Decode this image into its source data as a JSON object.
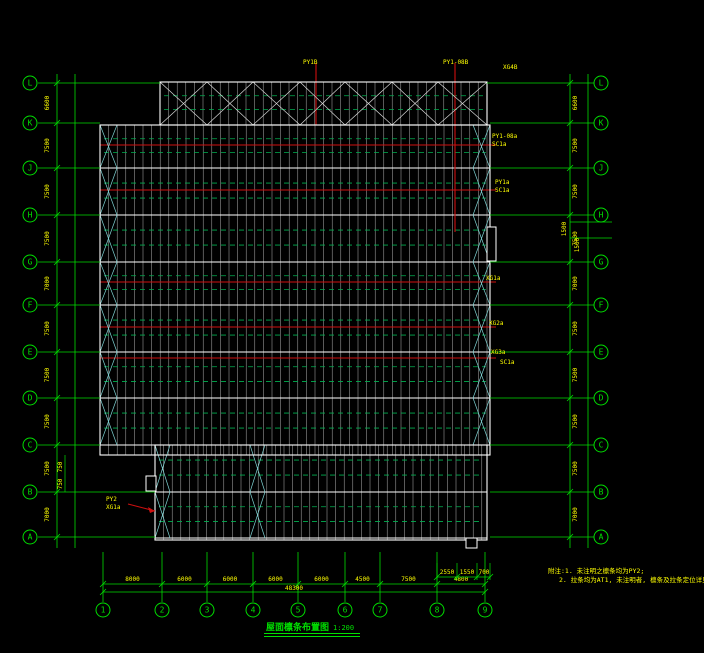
{
  "title": {
    "text": "屋面檩条布置图",
    "scale": "1:200"
  },
  "notes": {
    "line1": "附注:1. 未注明之檩条均为PY2;",
    "line2": "2. 拉条均为AT1, 未注明者, 檩条及拉条定位详见檩条大样图。"
  },
  "labels": {
    "top1": "PY1B",
    "top2": "PY1-08B",
    "top3": "XG4B",
    "red1a": "PY1-08a",
    "red1b": "SC1a",
    "red2a": "PY1a",
    "red2b": "SC1a",
    "red3": "XG1a",
    "red4": "XG2a",
    "red5a": "XG3a",
    "red5b": "SC1a",
    "bl1": "PY2",
    "bl2": "XG1a"
  },
  "axes": {
    "left": {
      "letters": [
        "L",
        "K",
        "J",
        "H",
        "G",
        "F",
        "E",
        "D",
        "C",
        "B",
        "A"
      ],
      "y": [
        83,
        123,
        168,
        215,
        262,
        305,
        352,
        398,
        445,
        492,
        537
      ]
    },
    "right": {
      "letters": [
        "L",
        "K",
        "J",
        "H",
        "G",
        "F",
        "E",
        "D",
        "C",
        "B",
        "A"
      ],
      "y": [
        83,
        123,
        168,
        215,
        262,
        305,
        352,
        398,
        445,
        492,
        537
      ]
    },
    "bottom": {
      "numbers": [
        "1",
        "2",
        "3",
        "4",
        "5",
        "6",
        "7",
        "8",
        "9"
      ],
      "x": [
        103,
        162,
        207,
        253,
        298,
        345,
        380,
        437,
        485
      ]
    }
  },
  "dims": {
    "left": [
      "6600",
      "7500",
      "7500",
      "7500",
      "7000",
      "7500",
      "7500",
      "7500",
      "7500",
      "7000"
    ],
    "right": [
      "6600",
      "7500",
      "7500",
      "7500",
      "7000",
      "7500",
      "7500",
      "7500",
      "7500",
      "7000"
    ],
    "bottom": [
      "8000",
      "6000",
      "6000",
      "6000",
      "6000",
      "4500",
      "7500",
      "4800"
    ],
    "bottom_total": "48300",
    "bottom_sub": [
      "2550",
      "1550",
      "700"
    ],
    "right_sub": [
      "1500",
      "1500"
    ],
    "left_sub": [
      "750",
      "750"
    ]
  },
  "colors": {
    "axis_green": "#00dd00",
    "tie_green": "#00b050",
    "dim_yellow": "#ffff00",
    "member_red": "#cf1010",
    "frame_white": "#ffffff",
    "purlin_gray": "#c8c8c8",
    "brace_cyan": "#7fd4d4",
    "title_green": "#00e000"
  },
  "geom": {
    "regions": [
      {
        "x1": 160,
        "y1": 82,
        "x2": 487,
        "y2": 125
      },
      {
        "x1": 100,
        "y1": 125,
        "x2": 490,
        "y2": 455
      },
      {
        "x1": 155,
        "y1": 445,
        "x2": 487,
        "y2": 540
      }
    ],
    "purlin_spacing": 8.6,
    "frame_rows": [
      125,
      168,
      215,
      262,
      305,
      352,
      398,
      445,
      492,
      538
    ],
    "red_y": [
      145,
      190,
      282,
      327,
      358
    ],
    "red_v": [
      {
        "x": 316,
        "y1": 63,
        "y2": 125
      },
      {
        "x": 455,
        "y1": 63,
        "y2": 232
      }
    ],
    "top_bays": [
      160,
      207,
      253,
      300,
      345,
      392,
      438,
      487
    ],
    "bottom_brace_x": [
      155,
      250
    ],
    "tabs": [
      {
        "x": 487,
        "y": 227,
        "w": 9,
        "h": 34
      },
      {
        "x": 146,
        "y": 476,
        "w": 10,
        "h": 15
      },
      {
        "x": 466,
        "y": 538,
        "w": 11,
        "h": 10
      }
    ]
  }
}
